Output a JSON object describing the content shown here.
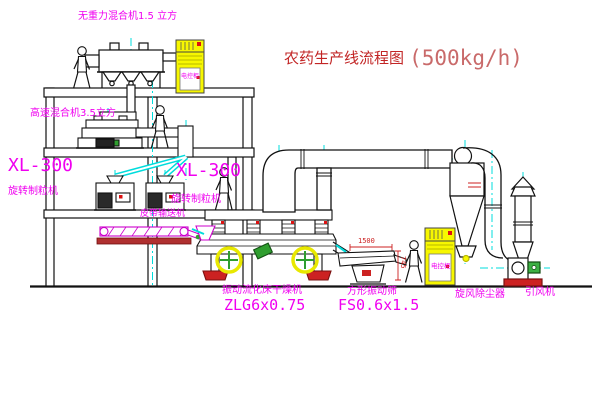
{
  "title": {
    "name": "农药生产线流程图",
    "capacity": "(500kg/h)"
  },
  "labels": {
    "gravity_free_mixer": "无重力混合机1.5 立方",
    "high_speed_mixer": "高速混合机3.5立方",
    "granulator_left_model": "XL-300",
    "granulator_left_name": "旋转制粒机",
    "granulator_right_model": "XL-300",
    "granulator_right_name": "旋转制粒机",
    "belt_conveyor": "皮带输送机",
    "dryer_name": "振动流化床干燥机",
    "dryer_model": "ZLG6x0.75",
    "sieve_name": "方形振动筛",
    "sieve_model": "FS0.6x1.5",
    "cyclone_name": "旋风除尘器",
    "fan_name": "引风机",
    "cabinet_text": "电控柜"
  },
  "dimensions": {
    "sieve_length": "1500",
    "sieve_height": "745"
  },
  "colors": {
    "label_magenta": "#f000f0",
    "title_red": "#c22525",
    "capacity_red": "#c96a6a",
    "line_black": "#111111",
    "centerline_cyan": "#00dcdc",
    "cabinet_yellow": "#f7f700",
    "accent_red": "#dd1111",
    "accent_green": "#2f9e2f"
  }
}
